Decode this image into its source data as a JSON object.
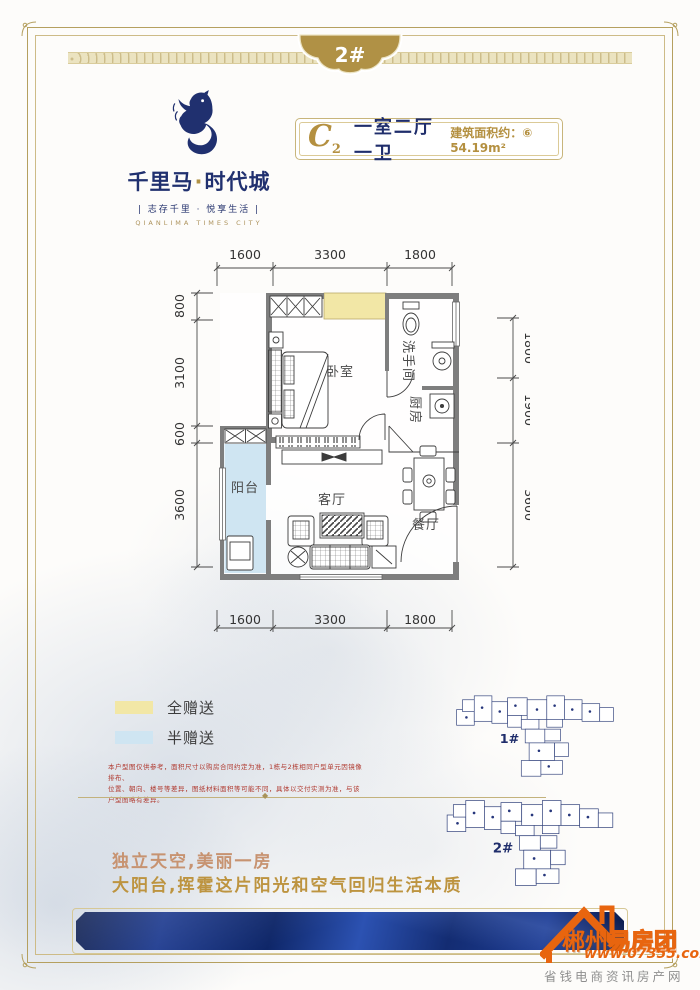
{
  "badge": {
    "label": "2#"
  },
  "logo": {
    "name_left": "千里马",
    "name_dot": "·",
    "name_right": "时代城",
    "slogan": "| 志存千里 · 悦享生活 |",
    "english": "QIANLIMA TIMES CITY"
  },
  "unit": {
    "code": "C",
    "code_sub": "2",
    "layout": "一室二厅一卫",
    "area_prefix": "建筑面积约：",
    "area_mark": "⑥",
    "area_value": "54.19m²"
  },
  "floorplan": {
    "rooms": {
      "bedroom": "卧室",
      "bath": "洗手间",
      "kitchen": "厨房",
      "living": "客厅",
      "dining": "餐厅",
      "balcony": "阳台"
    },
    "dims": {
      "top": [
        "1600",
        "3300",
        "1800"
      ],
      "bottom": [
        "1600",
        "3300",
        "1800"
      ],
      "left": [
        "800",
        "3100",
        "600",
        "3600"
      ],
      "right": [
        "1800",
        "1900",
        "3600"
      ]
    },
    "colors": {
      "gift_full": "#f2e7a6",
      "gift_half": "#cfe5f2",
      "wall": "#7e7e7e"
    }
  },
  "legend": [
    {
      "label": "全赠送",
      "color": "#f2e7a6"
    },
    {
      "label": "半赠送",
      "color": "#cfe5f2"
    }
  ],
  "siteplans": [
    {
      "label": "1#"
    },
    {
      "label": "2#",
      "highlight_color": "#7cc0e8"
    }
  ],
  "disclaimer": {
    "line1": "本户型图仅供参考，面积尺寸以购房合同约定为准，1栋与2栋相同户型单元因镜像排布、",
    "line2": "位置、朝向、楼号等差异，图纸材料面积等可能不同，具体以交付实测为准，与该户型图略有差异。"
  },
  "tagline": {
    "line1": "独立天空,美丽一房",
    "line2": "大阳台,挥霍这片阳光和空气回归生活本质"
  },
  "watermark": {
    "brand_solid": "郴州",
    "brand_outline": "易房团",
    "url": "www.07355.com",
    "slogan": "省钱电商资讯房产网"
  }
}
